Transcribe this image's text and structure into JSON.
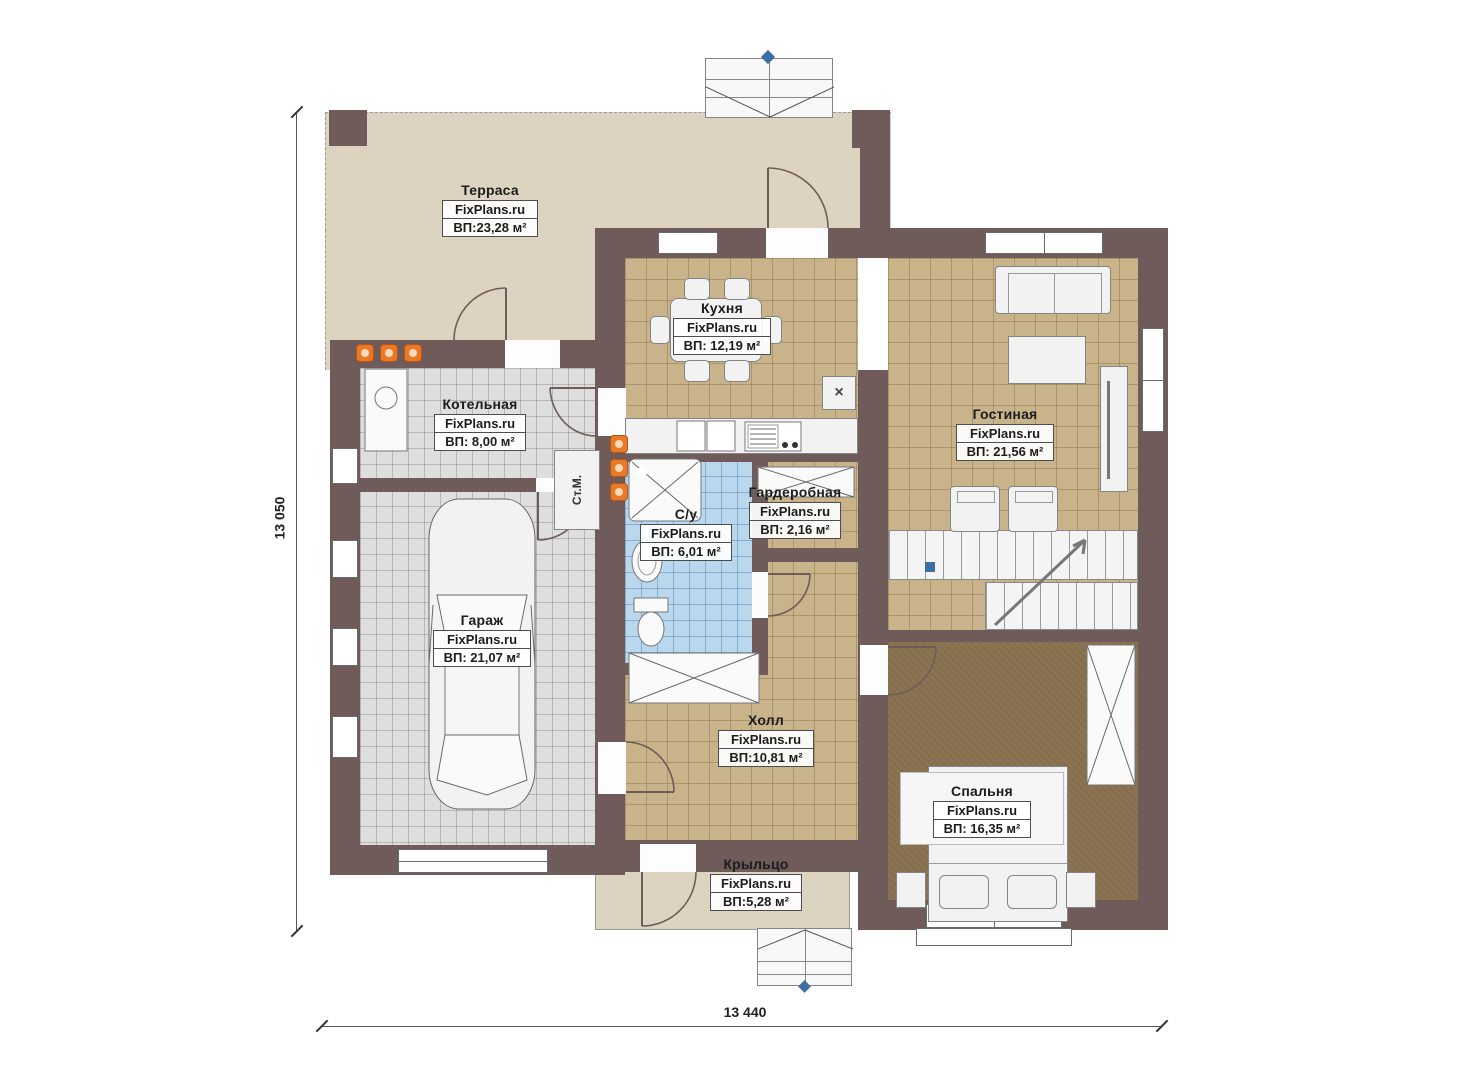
{
  "plan": {
    "brand": "FixPlans.ru",
    "rooms": [
      {
        "id": "terrace",
        "name": "Терраса",
        "area": "ВП:23,28 м²"
      },
      {
        "id": "kitchen",
        "name": "Кухня",
        "area": "ВП: 12,19 м²"
      },
      {
        "id": "boiler",
        "name": "Котельная",
        "area": "ВП: 8,00 м²"
      },
      {
        "id": "living",
        "name": "Гостиная",
        "area": "ВП: 21,56 м²"
      },
      {
        "id": "wardrobe",
        "name": "Гардеробная",
        "area": "ВП: 2,16 м²"
      },
      {
        "id": "bathroom",
        "name": "С/у",
        "area": "ВП: 6,01 м²"
      },
      {
        "id": "garage",
        "name": "Гараж",
        "area": "ВП: 21,07 м²"
      },
      {
        "id": "hall",
        "name": "Холл",
        "area": "ВП:10,81 м²"
      },
      {
        "id": "bedroom",
        "name": "Спальня",
        "area": "ВП: 16,35 м²"
      },
      {
        "id": "porch",
        "name": "Крыльцо",
        "area": "ВП:5,28 м²"
      }
    ],
    "dimensions": {
      "height": "13 050",
      "width": "13 440"
    },
    "annotations": {
      "washing_machine": "Ст.М.",
      "vent": "×"
    },
    "colors": {
      "wall": "#6f5c5a",
      "terrace_floor": "#ddd3c1",
      "tile_tan": "#c9b38b",
      "tile_gray": "#dedede",
      "tile_blue": "#b9d8ee",
      "bedroom_floor": "#8b7452",
      "radiator": "#e87a2a",
      "marker": "#3a6ea5"
    }
  }
}
